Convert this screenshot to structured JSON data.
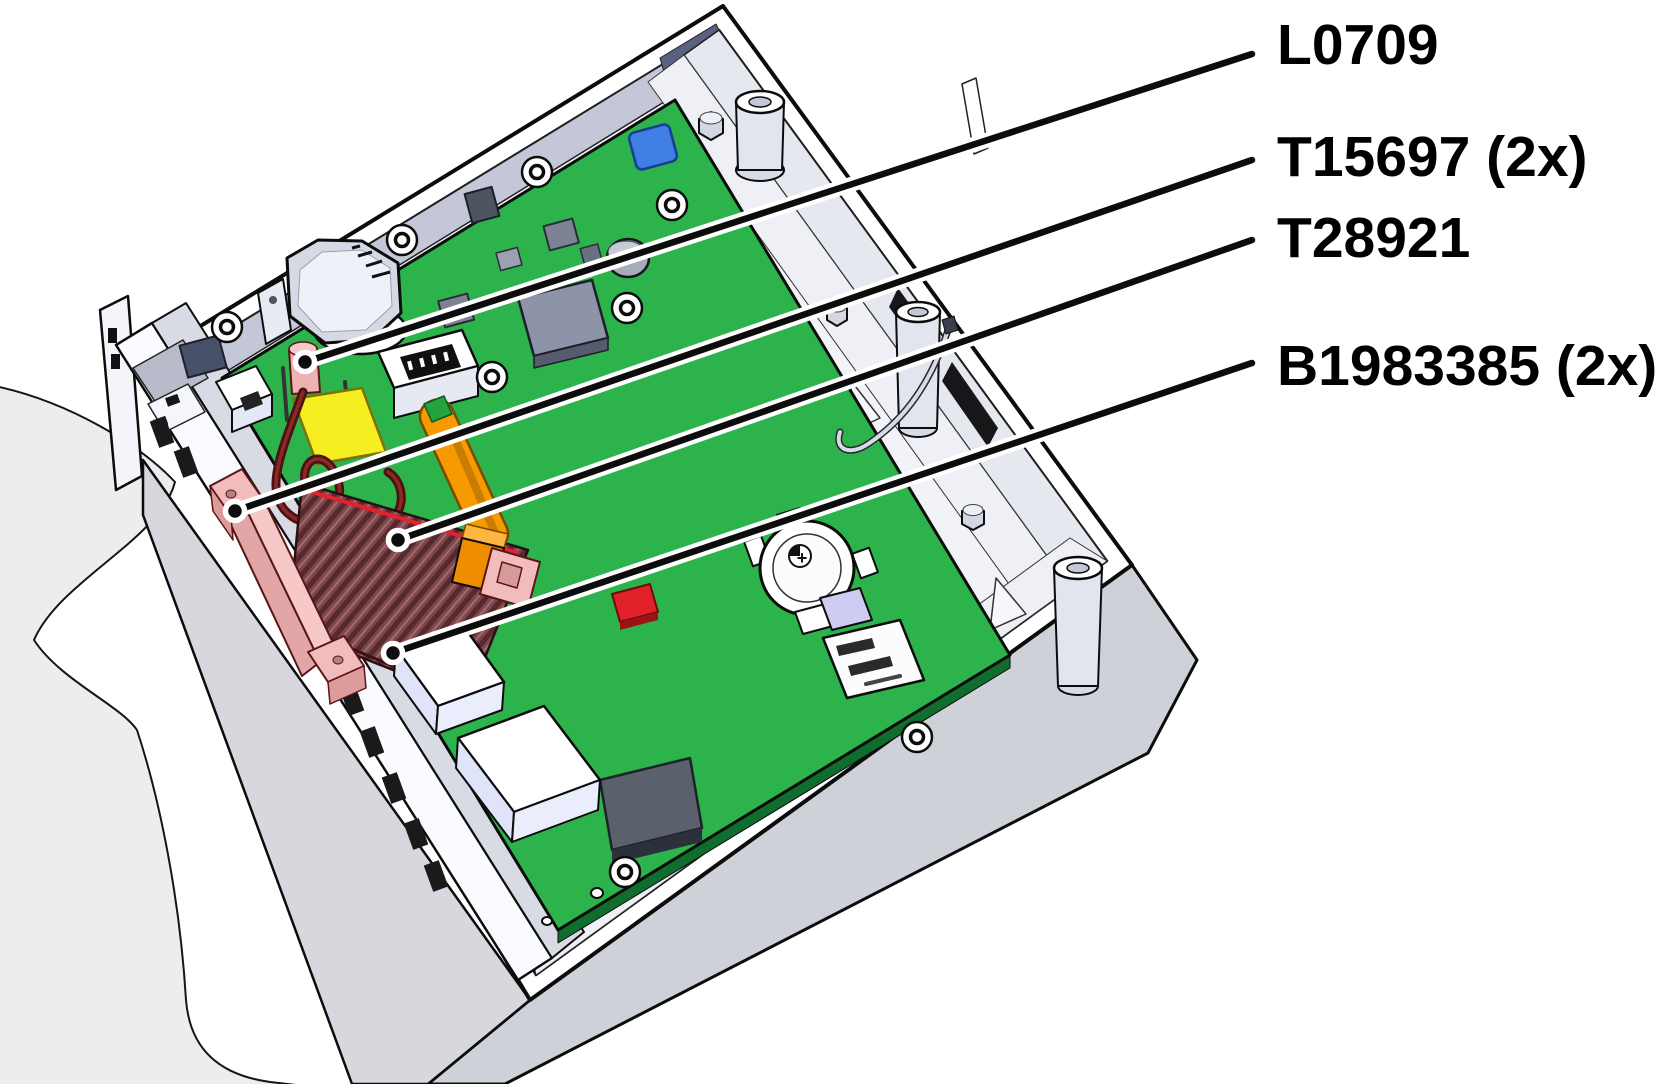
{
  "diagram": {
    "type": "exploded-hardware-callout-diagram",
    "subject": "electronics enclosure opened, mainboard with labelled spare parts",
    "background": "#ffffff",
    "battery_plus": "+",
    "callouts": [
      {
        "id": "L0709",
        "label": "L0709",
        "label_x": 1277,
        "label_y": 64,
        "tail_x": 1252,
        "tail_y": 54,
        "dot_x": 305,
        "dot_y": 362
      },
      {
        "id": "T15697",
        "label": "T15697 (2x)",
        "label_x": 1277,
        "label_y": 176,
        "tail_x": 1252,
        "tail_y": 160,
        "dot_x": 235,
        "dot_y": 511
      },
      {
        "id": "T28921",
        "label": "T28921",
        "label_x": 1277,
        "label_y": 257,
        "tail_x": 1252,
        "tail_y": 240,
        "dot_x": 398,
        "dot_y": 540
      },
      {
        "id": "B1983385",
        "label": "B1983385 (2x)",
        "label_x": 1277,
        "label_y": 385,
        "tail_x": 1252,
        "tail_y": 363,
        "dot_x": 393,
        "dot_y": 653
      }
    ],
    "line_style": {
      "stroke": "#0c0c0c",
      "casing": "#ffffff",
      "width": 6.5,
      "casing_width": 15,
      "dot_radius": 9.5,
      "dot_ring": 5.5
    },
    "colors": {
      "pcb": "#2db34c",
      "pcb_edge": "#0f6e2d",
      "line": "#0c0c0c",
      "inner": "#f2f3f6",
      "wall_outer": "#ced1d8",
      "wall_sw": "#d6d8de",
      "wall_nw": "#c3c7d8",
      "wall_ne": "#e6e8ef",
      "shelf": "#eef0f5",
      "blob": "#ededee",
      "metal": "#d6d9e4",
      "pink": "#f6c8c8",
      "pink_dark": "#e3a6a6",
      "pink_line": "#5a1518",
      "ribbon": "#7e454a",
      "ribbon_stripe": "#56292e",
      "ribbon_red": "#e8202a",
      "orange": "#f59a00",
      "orange_dark": "#c87c00",
      "yellow": "#f6ee20",
      "wire": "#4d1013",
      "wire_hi": "#8a2a24",
      "red": "#e02128",
      "blue": "#3f7fe3",
      "chip": "#8d93a8",
      "chip_dark": "#4f5463",
      "lavender": "#cdcdf2",
      "white": "#ffffff"
    }
  }
}
